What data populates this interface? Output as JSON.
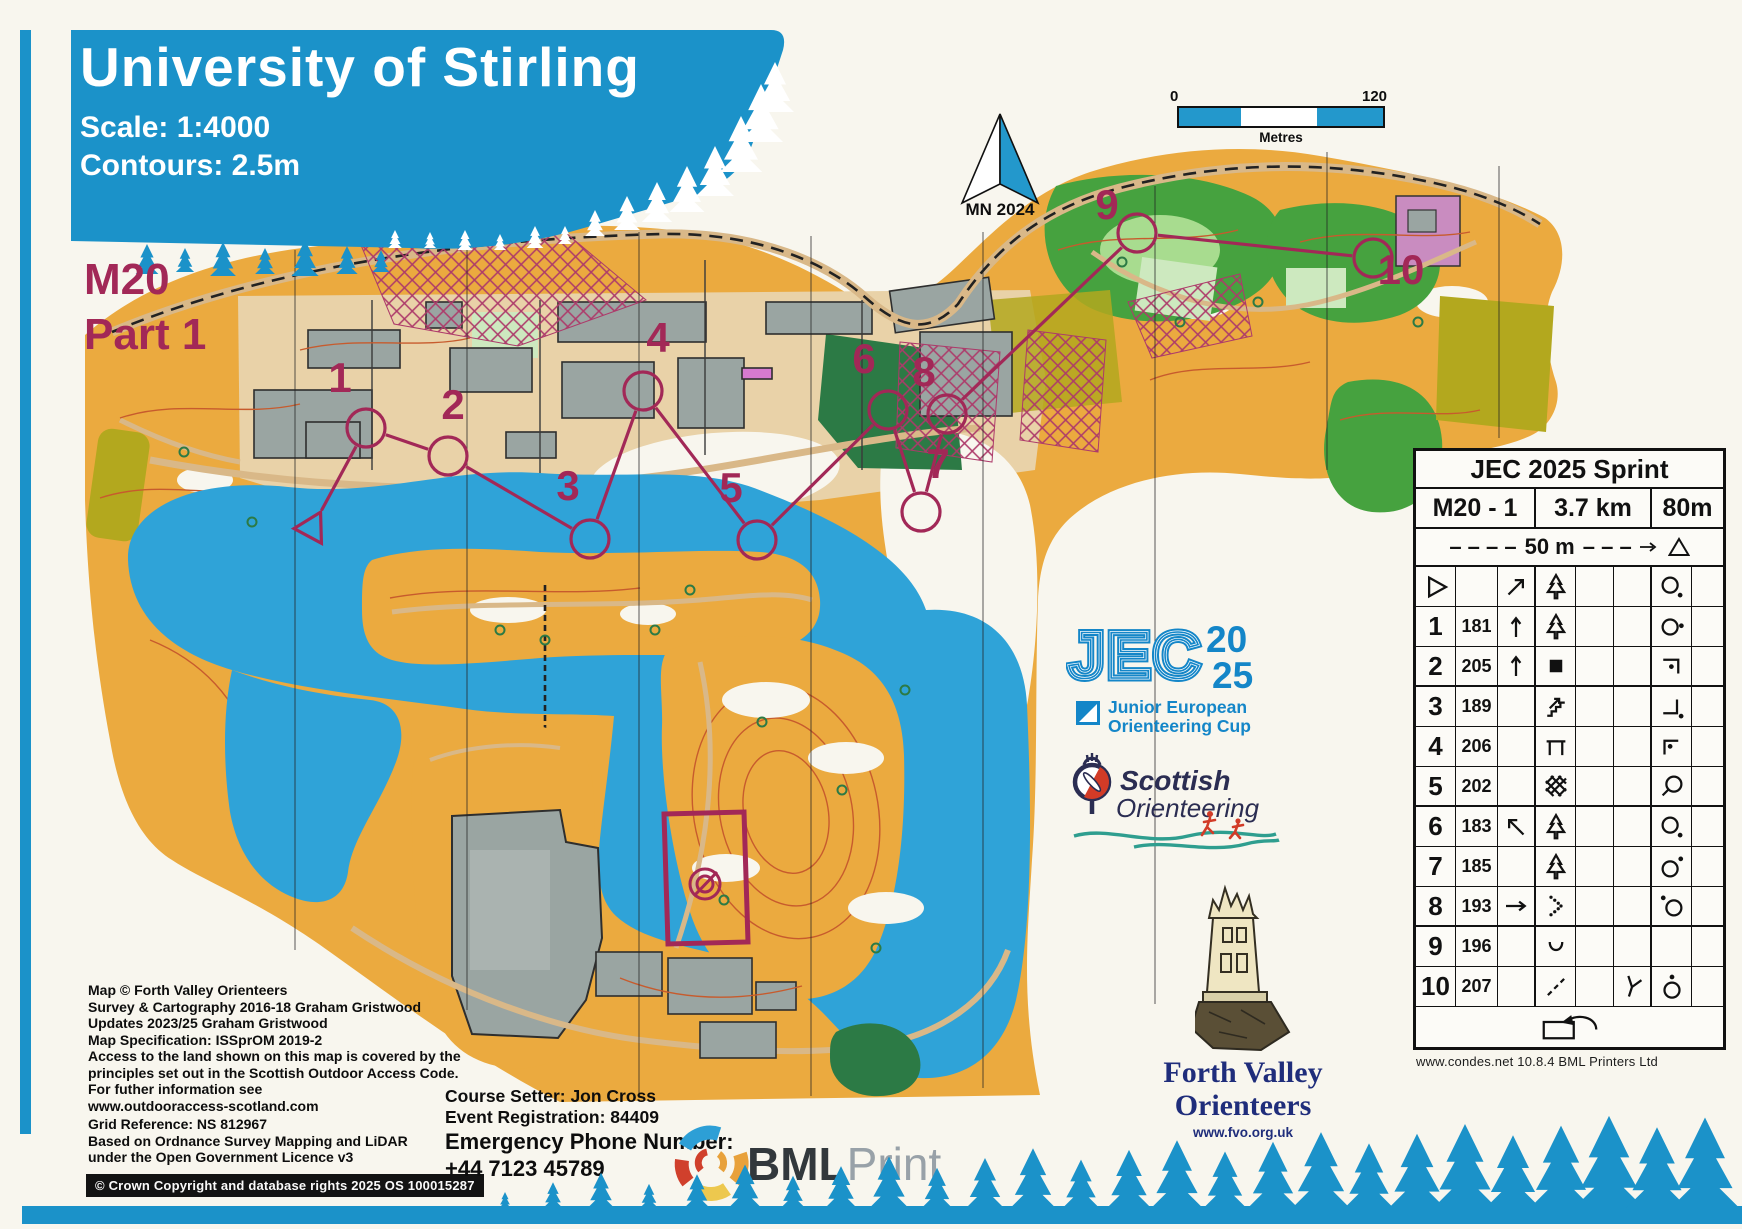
{
  "banner": {
    "title": "University of Stirling",
    "scale": "Scale:  1:4000",
    "contours": "Contours:  2.5m"
  },
  "course_id": {
    "cls": "M20",
    "part": "Part 1"
  },
  "north": {
    "label": "MN 2024"
  },
  "scalebar": {
    "zero": "0",
    "max": "120",
    "unit": "Metres"
  },
  "jec": {
    "name": "JEC",
    "y1": "20",
    "y2": "25",
    "t1": "Junior European",
    "t2": "Orienteering Cup"
  },
  "scottish": {
    "l1": "Scottish",
    "l2": "Orienteering"
  },
  "fvo": {
    "l1": "Forth Valley",
    "l2": "Orienteers",
    "url": "www.fvo.org.uk"
  },
  "bml": {
    "b": "BML",
    "l": "Print"
  },
  "setter": {
    "l1": "Course Setter: Jon Cross",
    "l2": "Event Registration: 84409"
  },
  "emergency": {
    "l1": "Emergency Phone Number:",
    "l2": "+44 7123 45789"
  },
  "credits": {
    "p1": "Map © Forth Valley Orienteers\nSurvey & Cartography 2016-18 Graham Gristwood\nUpdates 2023/25 Graham Gristwood\nMap Specification: ISSprOM 2019-2",
    "p2": "Access to the land shown on this map is covered by the\nprinciples set out in the Scottish Outdoor Access Code.\nFor futher information see\nwww.outdooraccess-scotland.com",
    "p3": "Grid Reference: NS 812967\nBased on Ordnance Survey Mapping and LiDAR\nunder the Open Government Licence v3",
    "crown": "© Crown Copyright and database rights 2025 OS 100015287"
  },
  "table": {
    "title": "JEC 2025 Sprint",
    "course": "M20 - 1",
    "length": "3.7 km",
    "climb": "80m",
    "dash_left": "– – – –",
    "interval": "50 m",
    "dash_right": "– – –",
    "footer": "www.condes.net 10.8.4 BML Printers Ltd",
    "rows": [
      {
        "num": "",
        "code": "",
        "c": "arrow-ne",
        "d": "spruce",
        "e": "",
        "f": "",
        "g": "circle-dot-se",
        "h": "",
        "start": true
      },
      {
        "num": "1",
        "code": "181",
        "c": "arrow-n",
        "d": "spruce",
        "e": "",
        "f": "",
        "g": "circle-dot-e",
        "h": ""
      },
      {
        "num": "2",
        "code": "205",
        "c": "arrow-n",
        "d": "building",
        "e": "",
        "f": "",
        "g": "corner-ne-dot",
        "h": "",
        "thick": true
      },
      {
        "num": "3",
        "code": "189",
        "c": "",
        "d": "stairs",
        "e": "",
        "f": "",
        "g": "corner-se-dot",
        "h": ""
      },
      {
        "num": "4",
        "code": "206",
        "c": "",
        "d": "canopy",
        "e": "",
        "f": "",
        "g": "corner-nw-dot",
        "h": ""
      },
      {
        "num": "5",
        "code": "202",
        "c": "",
        "d": "thicket",
        "e": "",
        "f": "",
        "g": "circle-tail-sw",
        "h": "",
        "thick": true
      },
      {
        "num": "6",
        "code": "183",
        "c": "arrow-nw",
        "d": "spruce",
        "e": "",
        "f": "",
        "g": "circle-dot-se",
        "h": ""
      },
      {
        "num": "7",
        "code": "185",
        "c": "",
        "d": "spruce",
        "e": "",
        "f": "",
        "g": "circle-dot-ne",
        "h": ""
      },
      {
        "num": "8",
        "code": "193",
        "c": "arrow-e",
        "d": "veg-boundary",
        "e": "",
        "f": "",
        "g": "circle-dot-nw",
        "h": "",
        "thick": true
      },
      {
        "num": "9",
        "code": "196",
        "c": "",
        "d": "earth-bank",
        "e": "",
        "f": "",
        "g": "",
        "h": ""
      },
      {
        "num": "10",
        "code": "207",
        "c": "",
        "d": "path-dashed",
        "e": "",
        "f": "junction",
        "g": "circle-dot-n",
        "h": ""
      },
      {
        "finish": true
      }
    ]
  },
  "map": {
    "colors": {
      "water": "#2fa3d8",
      "terrain": "#ebaa3f",
      "terrain_light": "#f3cd7c",
      "paved": "#e9d2a8",
      "building": "#9aa5a2",
      "green": "#46a23f",
      "green_dark": "#2c7a45",
      "green_light": "#a8dc8f",
      "olive": "#b3a81e",
      "contour": "#c75b2d",
      "oob": "#ad3a6a",
      "course": "#a22857",
      "banner_blue": "#1b92c9",
      "jec_blue": "#1486c8",
      "scottish_navy": "#2b2d52",
      "scottish_red": "#d23b27",
      "teal": "#2f9e8f",
      "navy_text": "#1f2d7b"
    },
    "start": {
      "x": 312,
      "y": 528
    },
    "controls": [
      {
        "n": "1",
        "x": 366,
        "y": 428,
        "lx": 340,
        "ly": 392
      },
      {
        "n": "2",
        "x": 448,
        "y": 456,
        "lx": 453,
        "ly": 419
      },
      {
        "n": "3",
        "x": 590,
        "y": 539,
        "lx": 568,
        "ly": 500
      },
      {
        "n": "4",
        "x": 643,
        "y": 391,
        "lx": 658,
        "ly": 352
      },
      {
        "n": "5",
        "x": 757,
        "y": 540,
        "lx": 731,
        "ly": 502
      },
      {
        "n": "6",
        "x": 888,
        "y": 410,
        "lx": 864,
        "ly": 373
      },
      {
        "n": "7",
        "x": 921,
        "y": 512,
        "lx": 938,
        "ly": 478
      },
      {
        "n": "8",
        "x": 947,
        "y": 414,
        "lx": 924,
        "ly": 386
      },
      {
        "n": "9",
        "x": 1137,
        "y": 233,
        "lx": 1107,
        "ly": 219
      },
      {
        "n": "10",
        "x": 1373,
        "y": 258,
        "lx": 1401,
        "ly": 284
      }
    ]
  }
}
